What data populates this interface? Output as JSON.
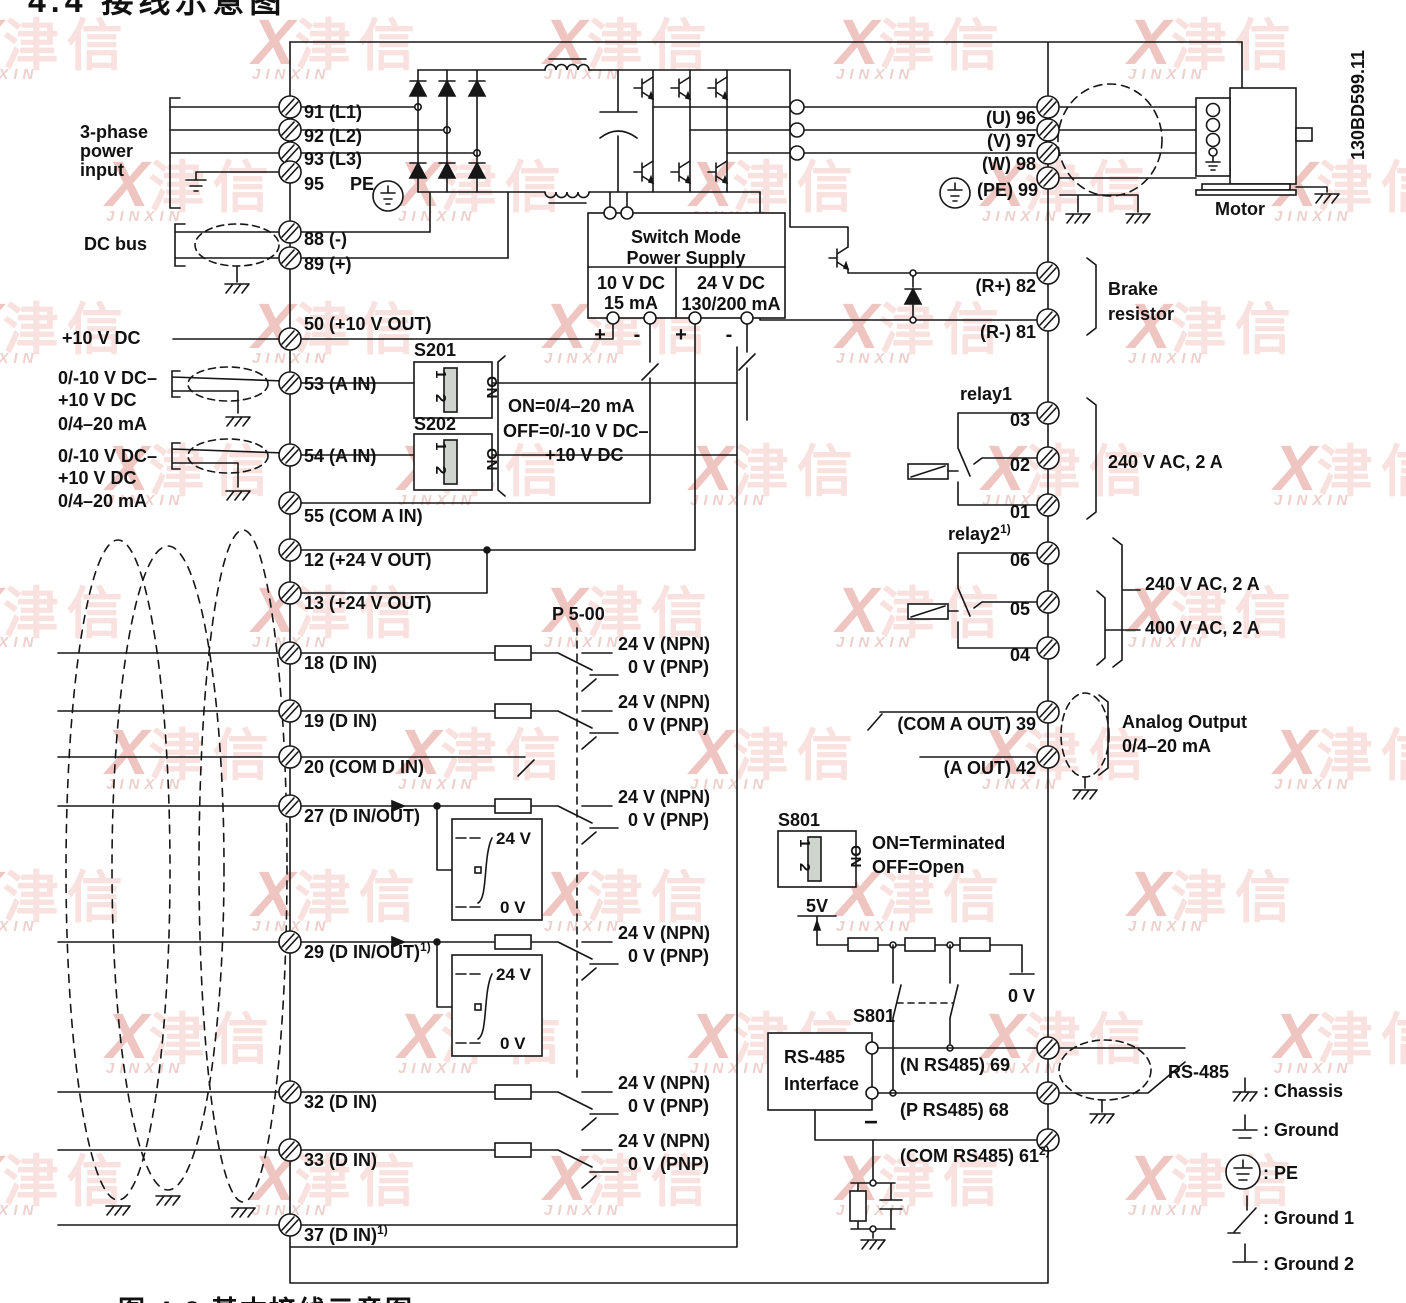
{
  "titles": {
    "top": "4.4 接线示意图",
    "bottom_caption": "图 4-2 基本接线示意图",
    "doc_code": "130BD599.11"
  },
  "watermark": {
    "x": "X",
    "cn": "津信",
    "en": "JINXIN"
  },
  "colors": {
    "line": "#161616",
    "text": "#111111",
    "watermark_red": "#dd7f78",
    "watermark_pink": "#f0beb9"
  },
  "labels": {
    "three_phase_1": "3-phase",
    "three_phase_2": "power",
    "three_phase_3": "input",
    "dc_bus": "DC bus",
    "plus10": "+10 V DC",
    "ain_range_1": "0/-10 V DC–",
    "ain_range_2": "+10 V DC",
    "ain_range_3": "0/4–20 mA",
    "smps_1": "Switch Mode",
    "smps_2": "Power Supply",
    "smps_10v": "10 V DC",
    "smps_15ma": "15 mA",
    "smps_24v": "24 V DC",
    "smps_130ma": "130/200 mA",
    "plus": "+",
    "minus": "-",
    "s201": "S201",
    "s202": "S202",
    "s801": "S801",
    "dip_1": "1",
    "dip_2": "2",
    "dip_on": "ON",
    "s20x_on": "ON=0/4–20 mA",
    "s20x_off": "OFF=0/-10 V DC–",
    "s20x_off2": "+10 V DC",
    "s801_on": "ON=Terminated",
    "s801_off": "OFF=Open",
    "p500": "P 5-00",
    "npn": "24 V (NPN)",
    "pnp": "0 V (PNP)",
    "v24": "24 V",
    "v0": "0 V",
    "v5": "5V",
    "motor": "Motor",
    "brake_1": "Brake",
    "brake_2": "resistor",
    "relay1": "relay1",
    "relay2": "relay2",
    "relay2_sup": "1)",
    "relay1_rating": "240 V AC, 2 A",
    "relay2_rating_240": "240 V AC, 2 A",
    "relay2_rating_400": "400 V AC, 2 A",
    "analog_out_1": "Analog Output",
    "analog_out_2": "0/4–20 mA",
    "rs485_box_1": "RS-485",
    "rs485_box_2": "Interface",
    "rs485_cable": "RS-485",
    "minus_sign": "−"
  },
  "pe_label": "PE",
  "terminals_left": [
    {
      "label": "91 (L1)"
    },
    {
      "label": "92 (L2)"
    },
    {
      "label": "93 (L3)"
    },
    {
      "label": "95"
    },
    {
      "label": "88 (-)"
    },
    {
      "label": "89 (+)"
    },
    {
      "label": "50 (+10 V OUT)"
    },
    {
      "label": "53 (A IN)"
    },
    {
      "label": "54 (A IN)"
    },
    {
      "label": "55 (COM A IN)"
    },
    {
      "label": "12 (+24 V OUT)"
    },
    {
      "label": "13 (+24 V OUT)"
    },
    {
      "label": "18 (D IN)"
    },
    {
      "label": "19 (D IN)"
    },
    {
      "label": "20 (COM D IN)"
    },
    {
      "label": "27 (D IN/OUT)"
    },
    {
      "label": "29 (D IN/OUT)",
      "sup": "1)"
    },
    {
      "label": "32 (D IN)"
    },
    {
      "label": "33 (D IN)"
    },
    {
      "label": "37 (D IN)",
      "sup": "1)"
    }
  ],
  "terminals_right": {
    "u": "(U) 96",
    "v": "(V) 97",
    "w": "(W) 98",
    "pe": "(PE) 99",
    "rp": "(R+) 82",
    "rm": "(R-) 81",
    "r1": [
      "03",
      "02",
      "01"
    ],
    "r2": [
      "06",
      "05",
      "04"
    ],
    "com_aout": "(COM A OUT) 39",
    "aout": "(A OUT) 42",
    "n485": "(N RS485) 69",
    "p485": "(P RS485) 68",
    "com485": "(COM RS485) 61",
    "com485_sup": "2)"
  },
  "legend": [
    {
      "label": ": Chassis"
    },
    {
      "label": ": Ground"
    },
    {
      "label": ": PE"
    },
    {
      "label": ": Ground 1"
    },
    {
      "label": ": Ground 2"
    }
  ]
}
